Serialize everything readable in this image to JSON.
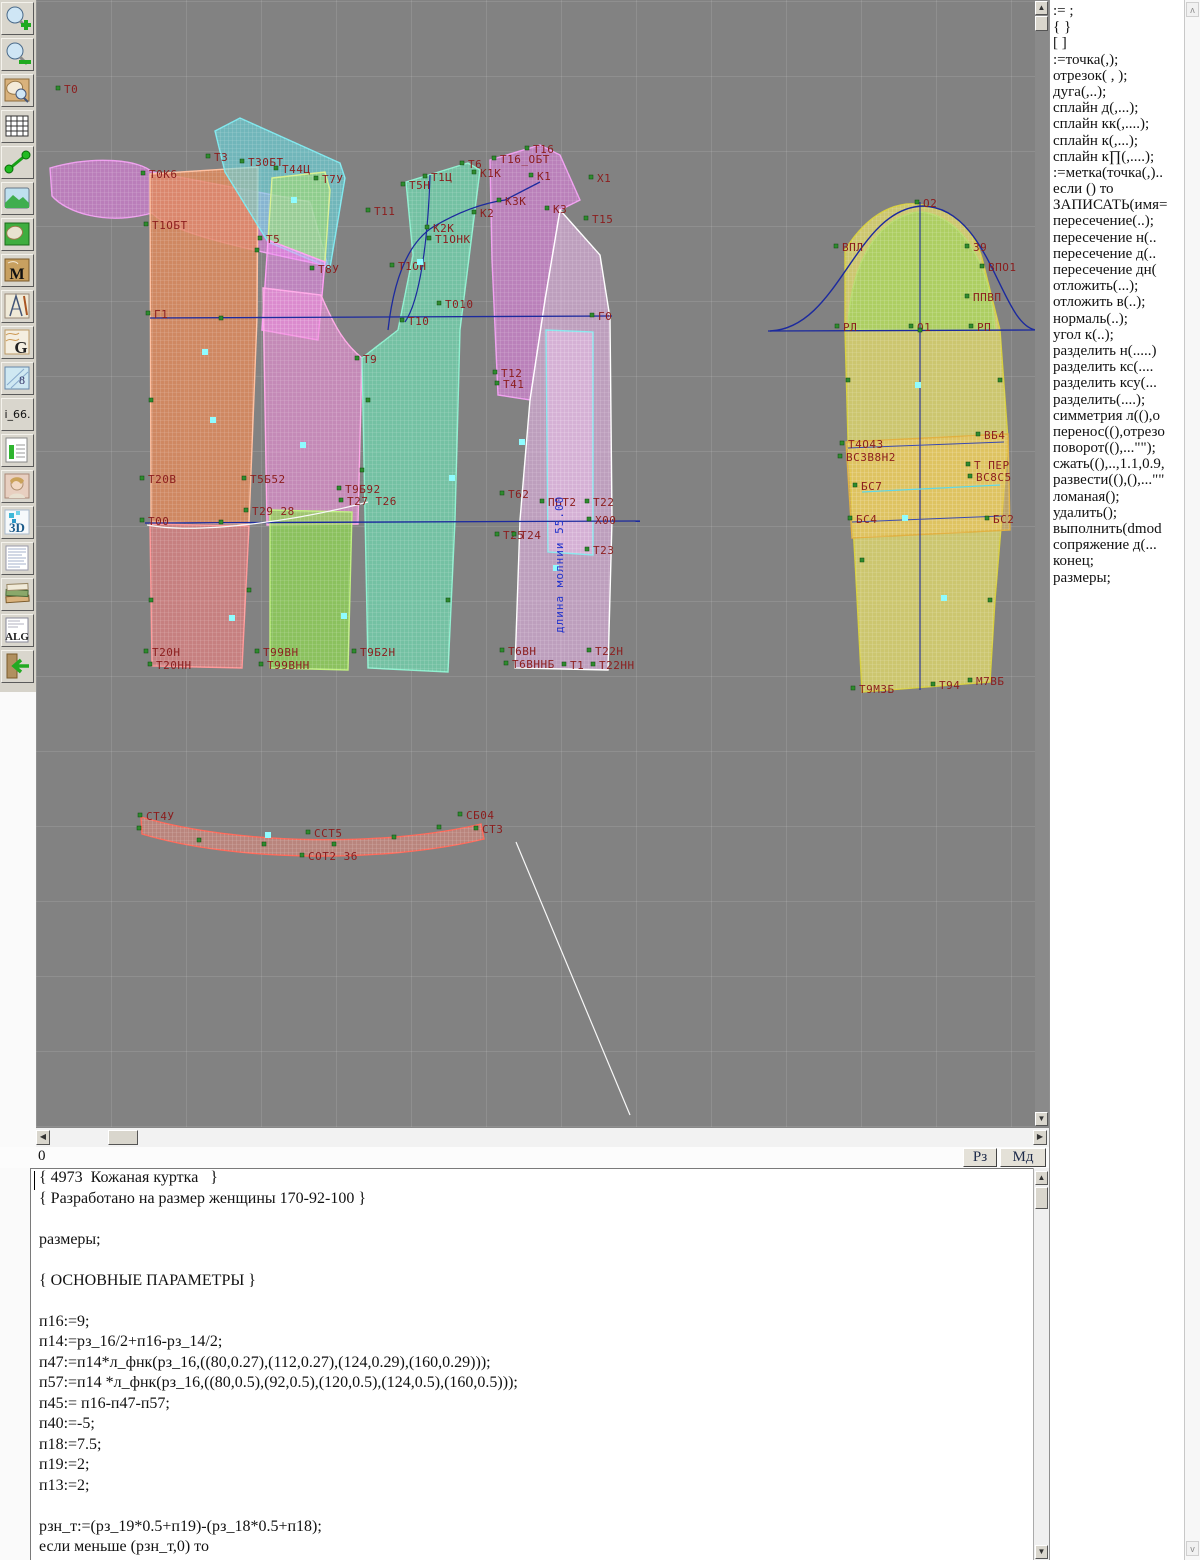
{
  "toolbar": {
    "glyphs": {
      "m": "M",
      "g": "G",
      "alg": "ALG",
      "threed": "3D",
      "i66": "i_66.",
      "sizes": "8"
    }
  },
  "canvas": {
    "bg": "#828282",
    "label_color": "#8b1d1d",
    "accent_blue": "#1c2a9e",
    "marker_green": "#2e8b2e",
    "marker_cyan": "#8ffcff",
    "vertical_label": {
      "text": "длина молнии 55.00",
      "x": 527,
      "y": 633
    },
    "pieces": [
      {
        "name": "collar-upper-swoosh",
        "d": "M14,168 C59,155 104,160 116,172 L274,202 L292,266 C204,248 134,232 116,213 C69,226 30,212 16,196 Z",
        "fill": "#df7bdf",
        "stroke": "#ef9fef",
        "op": 0.6
      },
      {
        "name": "back-upper",
        "d": "M114,174 L222,167 L221,318 L213,524 L115,522 Z",
        "fill": "#e2895a",
        "stroke": "#ffc0a0",
        "op": 0.8
      },
      {
        "name": "yoke-cyan",
        "d": "M179,131 L204,118 L304,163 L309,178 L294,268 L232,242 L189,172 Z",
        "fill": "#66d9e0",
        "stroke": "#7fe8ee",
        "op": 0.6
      },
      {
        "name": "side-green-small",
        "d": "M236,178 L289,172 L294,190 L289,262 L232,240 Z",
        "fill": "#a8e06a",
        "stroke": "#d8f090",
        "op": 0.55
      },
      {
        "name": "side-pink-small",
        "d": "M232,240 L289,262 L282,340 L226,330 Z",
        "fill": "#ef86ef",
        "stroke": "#ff9ff5",
        "op": 0.55
      },
      {
        "name": "side-pink-column",
        "d": "M227,288 L285,295 C300,330 310,345 326,358 L322,524 L231,525 Z",
        "fill": "#ee8fd8",
        "stroke": "#ffaae8",
        "op": 0.62
      },
      {
        "name": "front-teal",
        "d": "M370,182 L432,163 L444,170 L424,330 L419,520 L412,672 L332,668 L326,358 L362,330 L377,255 Z",
        "fill": "#6fd9b0",
        "stroke": "#90f0d0",
        "op": 0.72
      },
      {
        "name": "front-magenta-top",
        "d": "M454,160 L504,145 L524,155 L544,200 L524,210 L509,300 L494,400 L462,395 L456,260 Z",
        "fill": "#e080e0",
        "stroke": "#f0a0f0",
        "op": 0.6
      },
      {
        "name": "front-pinkwhite",
        "d": "M524,210 L564,255 L574,318 L576,520 L572,670 L479,668 L484,520 L494,400 L509,300 Z",
        "fill": "#eeb8ee",
        "stroke": "#ffffff",
        "op": 0.55
      },
      {
        "name": "zip-placket",
        "d": "M510,330 L557,332 L557,555 L512,552 Z",
        "fill": "#eac0ea",
        "stroke": "#8ae8ee",
        "op": 0.55
      },
      {
        "name": "back-lower-pink",
        "d": "M114,524 L213,526 L206,668 L116,666 Z",
        "fill": "#f08080",
        "stroke": "#ff9999",
        "op": 0.62
      },
      {
        "name": "mid-lower-green",
        "d": "M234,510 L316,512 L312,670 L234,668 Z",
        "fill": "#8fdc4f",
        "stroke": "#c0f080",
        "op": 0.7
      },
      {
        "name": "sleeve-yellow",
        "d": "M809,250 C834,210 864,200 887,205 C919,210 939,230 947,262 L964,330 L972,440 L964,540 L959,600 L954,682 L826,692 L819,560 L812,440 L809,330 Z",
        "fill": "#e9e168",
        "stroke": "#d8d040",
        "op": 0.72
      },
      {
        "name": "sleeve-cap-green",
        "d": "M812,330 C814,260 844,215 884,212 C924,215 954,260 959,330 Z",
        "fill": "#a5cf5f",
        "stroke": "#b8dc70",
        "op": 0.8
      },
      {
        "name": "sleeve-band-orange",
        "d": "M810,442 L972,434 L974,530 L816,538 Z",
        "fill": "#ecc155",
        "stroke": "#e0b040",
        "op": 0.55
      },
      {
        "name": "collar-stand-red",
        "d": "M105,817 C204,846 354,846 445,824 L448,839 C349,863 199,862 106,834 Z",
        "fill": "#f08878",
        "stroke": "#ff6a5a",
        "op": 0.5
      }
    ],
    "lines": [
      {
        "d": "M114,318 L576,316",
        "c": "#1c2a9e",
        "w": 1.3
      },
      {
        "d": "M109,523 L604,521",
        "c": "#1c2a9e",
        "w": 1.3
      },
      {
        "d": "M352,330 Q361,250 397,227 Q434,205 469,200 L504,182",
        "c": "#1c2a9e",
        "w": 1.3
      },
      {
        "d": "M394,175 C392,240 384,300 369,322",
        "c": "#1c2a9e",
        "w": 1.2
      },
      {
        "d": "M732,331 L1000,330",
        "c": "#1c2a9e",
        "w": 1.3
      },
      {
        "d": "M734,331 C804,328 819,208 887,206 C955,208 964,325 1000,330",
        "c": "#1c2a9e",
        "w": 1.4
      },
      {
        "d": "M884,202 L884,690",
        "c": "#1c2a9e",
        "w": 1.1
      },
      {
        "d": "M812,448 L968,442",
        "c": "#3a4ab0",
        "w": 1
      },
      {
        "d": "M826,492 L964,485",
        "c": "#5fd8e8",
        "w": 1.2
      },
      {
        "d": "M816,522 L966,516",
        "c": "#3a4ab0",
        "w": 1
      },
      {
        "d": "M111,525 C164,535 264,520 332,502",
        "c": "#f8f8f8",
        "w": 1.2
      },
      {
        "d": "M480,842 L594,1115",
        "c": "#f8f8f8",
        "w": 1.2
      }
    ],
    "labels": [
      [
        "Т0",
        28,
        90
      ],
      [
        "Т3",
        178,
        158
      ],
      [
        "Т30БТ",
        212,
        163
      ],
      [
        "Т44Ц",
        246,
        170
      ],
      [
        "Т7У",
        286,
        180
      ],
      [
        "Т0К6",
        113,
        175
      ],
      [
        "Т1ОБТ",
        116,
        226
      ],
      [
        "Т5",
        230,
        240
      ],
      [
        "Т8У",
        282,
        270
      ],
      [
        "Г1",
        118,
        315
      ],
      [
        "Т11",
        338,
        212
      ],
      [
        "Т5Н",
        373,
        186
      ],
      [
        "Т1Ц",
        395,
        178
      ],
      [
        "Т6",
        432,
        165
      ],
      [
        "К1К",
        444,
        174
      ],
      [
        "Т16",
        497,
        150
      ],
      [
        "Т16_ОБТ",
        464,
        160
      ],
      [
        "К1",
        501,
        177
      ],
      [
        "Х1",
        561,
        179
      ],
      [
        "К2",
        444,
        214
      ],
      [
        "К2К",
        397,
        229
      ],
      [
        "К3К",
        469,
        202
      ],
      [
        "К3",
        517,
        210
      ],
      [
        "Т15",
        556,
        220
      ],
      [
        "Т1ОНК",
        399,
        240
      ],
      [
        "Т1ОН",
        362,
        267
      ],
      [
        "Т010",
        409,
        305
      ],
      [
        "Г0",
        562,
        317
      ],
      [
        "Т10",
        372,
        322
      ],
      [
        "Т9",
        327,
        360
      ],
      [
        "Т12",
        465,
        374
      ],
      [
        "Т41",
        467,
        385
      ],
      [
        "Т20В",
        112,
        480
      ],
      [
        "Т5Б52",
        214,
        480
      ],
      [
        "Т9Б92",
        309,
        490
      ],
      [
        "Т27 Т26",
        311,
        502
      ],
      [
        "Т29 28",
        216,
        512
      ],
      [
        "Т00",
        112,
        522
      ],
      [
        "Т62",
        472,
        495
      ],
      [
        "ПБТ2",
        512,
        503
      ],
      [
        "Т22",
        557,
        503
      ],
      [
        "Х00",
        559,
        521
      ],
      [
        "Т25",
        467,
        536
      ],
      [
        "Т24",
        484,
        536
      ],
      [
        "Т23",
        557,
        551
      ],
      [
        "Т20Н",
        116,
        653
      ],
      [
        "Т20НН",
        120,
        666
      ],
      [
        "Т99ВН",
        227,
        653
      ],
      [
        "Т99ВНН",
        231,
        666
      ],
      [
        "Т9Б2Н",
        324,
        653
      ],
      [
        "Т6ВН",
        472,
        652
      ],
      [
        "Т6ВННБ",
        476,
        665
      ],
      [
        "Т1",
        534,
        666
      ],
      [
        "Т22Н",
        559,
        652
      ],
      [
        "Т22НН",
        563,
        666
      ],
      [
        "О2",
        887,
        204
      ],
      [
        "ВПЛ",
        806,
        248
      ],
      [
        "39",
        937,
        248
      ],
      [
        "ВПО1",
        952,
        268
      ],
      [
        "ППВП",
        937,
        298
      ],
      [
        "РЛ",
        807,
        328
      ],
      [
        "О1",
        881,
        328
      ],
      [
        "РП",
        941,
        328
      ],
      [
        "Т4О43",
        812,
        445
      ],
      [
        "ВС3В8Н2",
        810,
        458
      ],
      [
        "ВБ4",
        948,
        436
      ],
      [
        "Т ПЕР",
        938,
        466
      ],
      [
        "ВС8С5",
        940,
        478
      ],
      [
        "БС7",
        825,
        487
      ],
      [
        "БС4",
        820,
        520
      ],
      [
        "БС2",
        957,
        520
      ],
      [
        "Т9МЗБ",
        823,
        690
      ],
      [
        "Т94",
        903,
        686
      ],
      [
        "М7ВБ",
        940,
        682
      ],
      [
        "СТ4У",
        110,
        817
      ],
      [
        "ССТ5",
        278,
        834
      ],
      [
        "СОТ2 36",
        272,
        857
      ],
      [
        "СБ04",
        430,
        816
      ],
      [
        "СТ3",
        446,
        830
      ]
    ],
    "markers_extra": [
      [
        103,
        828
      ],
      [
        163,
        840
      ],
      [
        228,
        844
      ],
      [
        298,
        844
      ],
      [
        358,
        837
      ],
      [
        403,
        827
      ],
      [
        185,
        318
      ],
      [
        185,
        522
      ],
      [
        332,
        400
      ],
      [
        326,
        470
      ],
      [
        412,
        600
      ],
      [
        884,
        330
      ],
      [
        812,
        380
      ],
      [
        964,
        380
      ],
      [
        826,
        560
      ],
      [
        954,
        600
      ],
      [
        221,
        250
      ],
      [
        115,
        400
      ],
      [
        115,
        600
      ],
      [
        213,
        590
      ]
    ],
    "markers_cyan": [
      [
        169,
        352
      ],
      [
        177,
        420
      ],
      [
        267,
        445
      ],
      [
        196,
        618
      ],
      [
        308,
        616
      ],
      [
        416,
        478
      ],
      [
        486,
        442
      ],
      [
        520,
        568
      ],
      [
        882,
        385
      ],
      [
        869,
        518
      ],
      [
        908,
        598
      ],
      [
        232,
        835
      ],
      [
        384,
        262
      ],
      [
        258,
        200
      ]
    ]
  },
  "statusbar": {
    "left_value": "0",
    "rz_label": "Рз",
    "md_label": "Мд"
  },
  "commands": {
    "items": [
      ":= ;",
      "{  }",
      "[  ]",
      ":=точка(,);",
      "отрезок( , );",
      "дуга(,..);",
      "сплайн  д(,...);",
      "сплайн  кк(,....);",
      "сплайн  к(,...);",
      "сплайн  к∏(,....);",
      ":=метка(точка(,)..",
      "если () то",
      "ЗАПИСАТЬ(имя=",
      "пересечение(..);",
      "пересечение  н(..",
      "пересечение  д(..",
      "пересечение  дн(",
      "отложить(...);",
      "отложить  в(..);",
      "нормаль(..);",
      "угол  к(..);",
      "разделить  н(.....)",
      "разделить  кс(....",
      "разделить  ксу(...",
      "разделить(....);",
      "симметрия  л((),о",
      "перенос((),отрезо",
      "поворот((),...\"\");",
      "сжать((),..,1.1,0.9,",
      "развести((),(),...\"\"",
      "ломаная();",
      "удалить();",
      "выполнить(dmod",
      "сопряжение  д(...",
      "конец;",
      "размеры;"
    ]
  },
  "editor": {
    "lines": [
      "{ 4973  Кожаная куртка   }",
      "{ Разработано на размер женщины 170-92-100 }",
      "",
      "размеры;",
      "",
      "{ ОСНОВНЫЕ ПАРАМЕТРЫ }",
      "",
      "п16:=9;",
      "п14:=рз_16/2+п16-рз_14/2;",
      "п47:=п14*л_фнк(рз_16,((80,0.27),(112,0.27),(124,0.29),(160,0.29)));",
      "п57:=п14 *л_фнк(рз_16,((80,0.5),(92,0.5),(120,0.5),(124,0.5),(160,0.5)));",
      "п45:= п16-п47-п57;",
      "п40:=-5;",
      "п18:=7.5;",
      "п19:=2;",
      "п13:=2;",
      "",
      "рзн_т:=(рз_19*0.5+п19)-(рз_18*0.5+п18);",
      "если меньше (рзн_т,0) то"
    ]
  }
}
